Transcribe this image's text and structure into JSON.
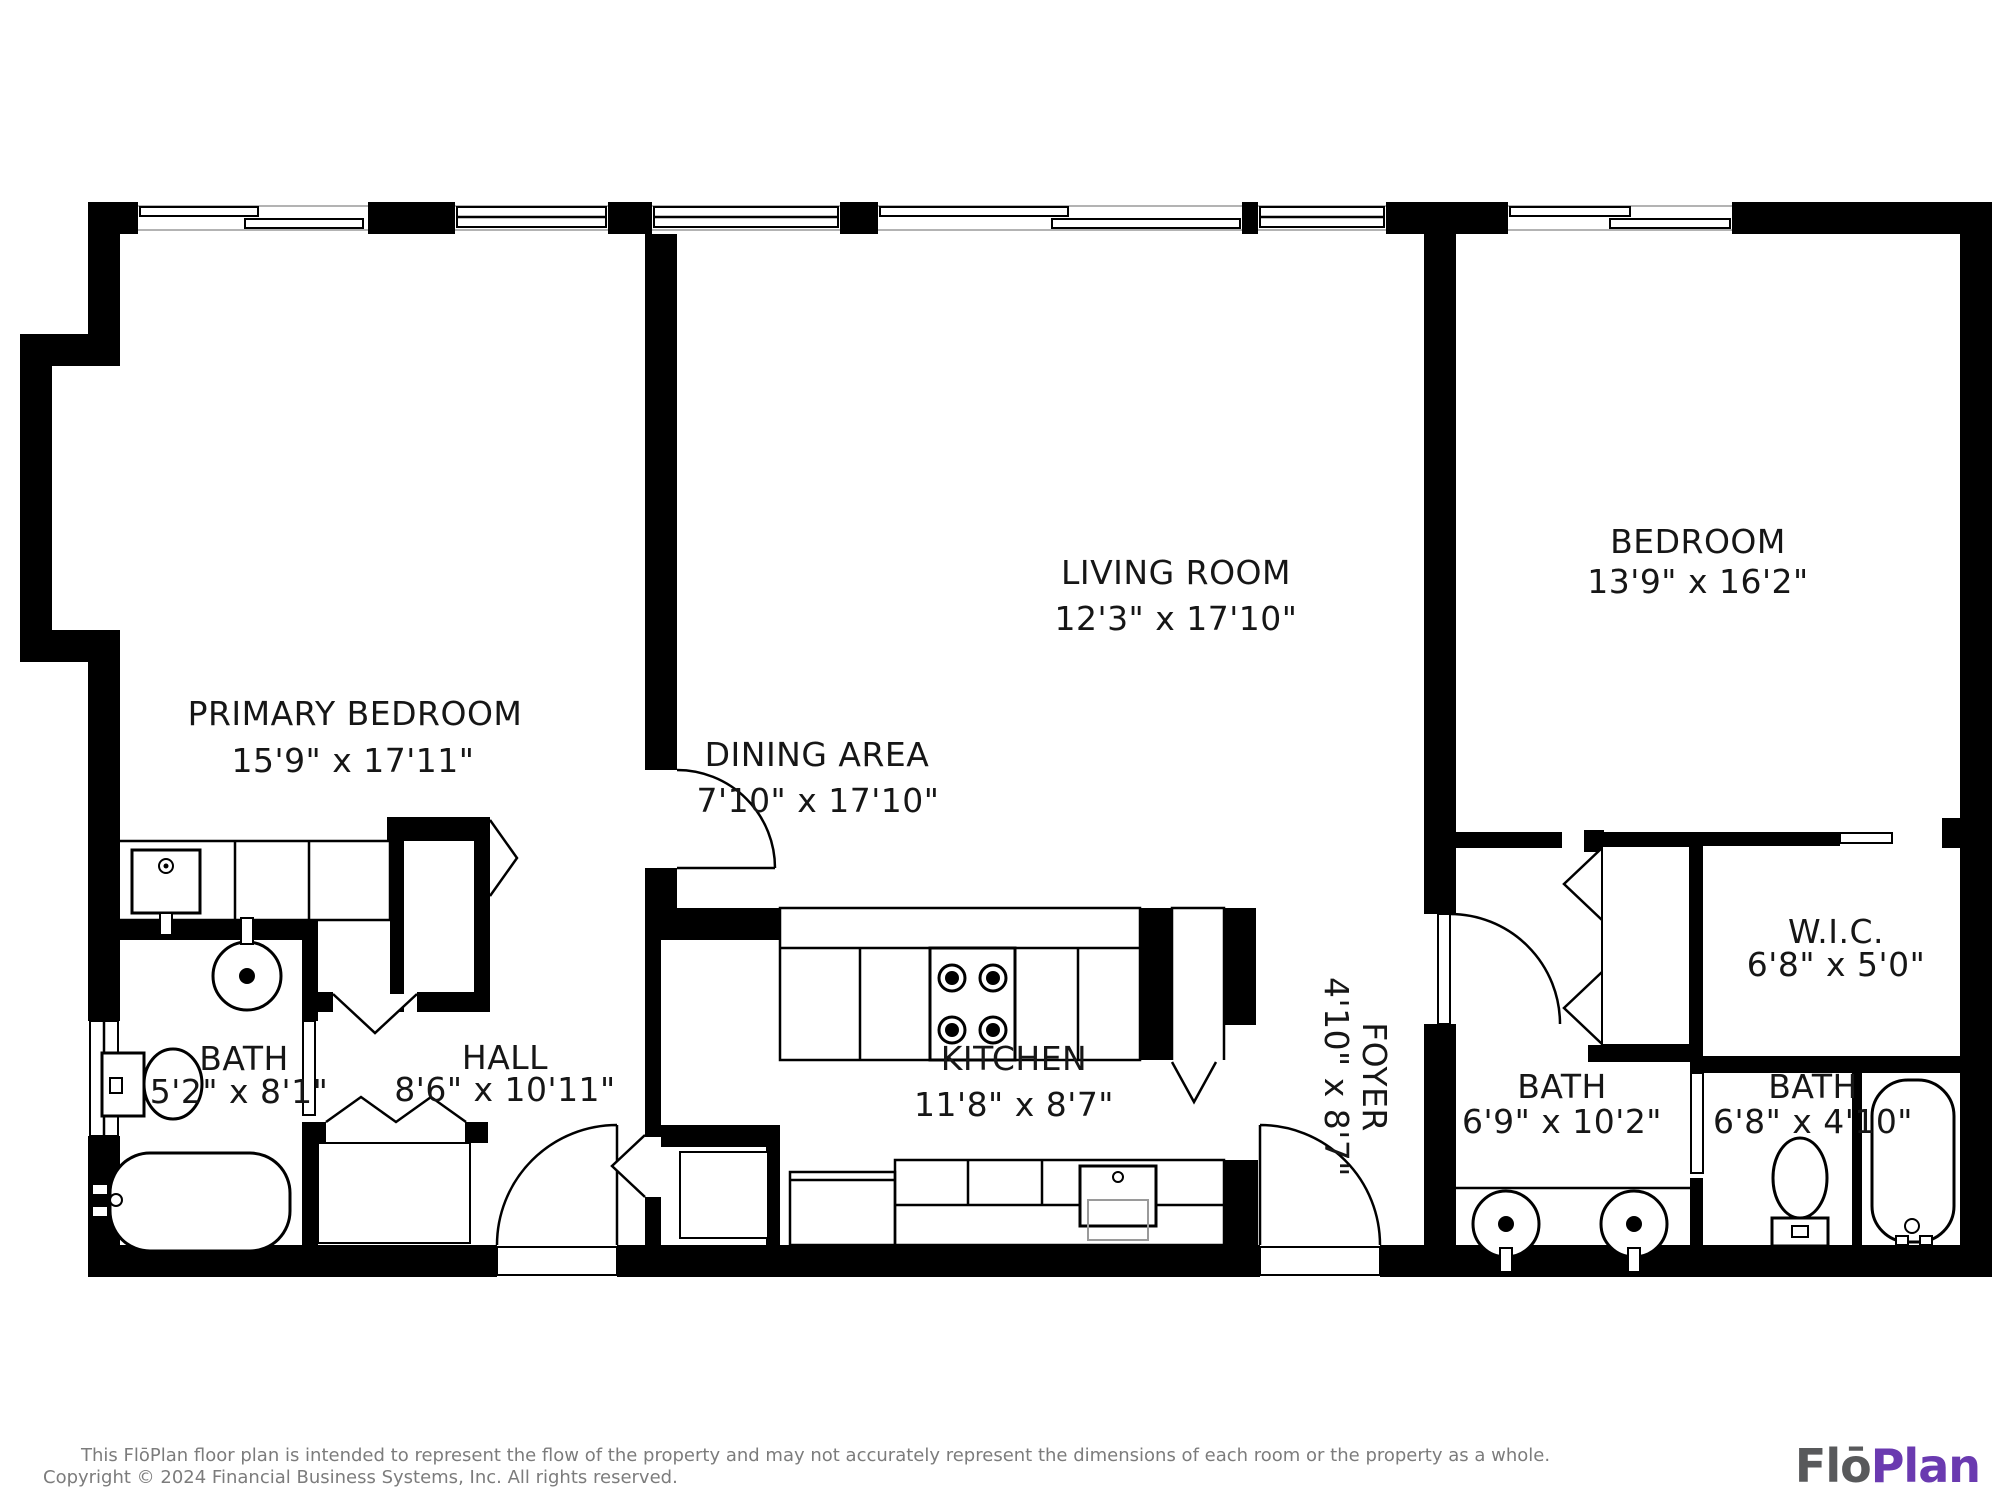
{
  "plan": {
    "rooms": [
      {
        "id": "primary-bedroom",
        "name": "PRIMARY BEDROOM",
        "dims": "15'9\" x 17'11\""
      },
      {
        "id": "dining-area",
        "name": "DINING AREA",
        "dims": "7'10\" x 17'10\""
      },
      {
        "id": "living-room",
        "name": "LIVING ROOM",
        "dims": "12'3\" x 17'10\""
      },
      {
        "id": "bedroom",
        "name": "BEDROOM",
        "dims": "13'9\" x 16'2\""
      },
      {
        "id": "bath-primary",
        "name": "BATH",
        "dims": "5'2\" x 8'1\""
      },
      {
        "id": "hall",
        "name": "HALL",
        "dims": "8'6\" x 10'11\""
      },
      {
        "id": "kitchen",
        "name": "KITCHEN",
        "dims": "11'8\" x 8'7\""
      },
      {
        "id": "foyer",
        "name": "FOYER",
        "dims": "4'10\" x 8'7\""
      },
      {
        "id": "wic",
        "name": "W.I.C.",
        "dims": "6'8\" x 5'0\""
      },
      {
        "id": "bath-hall",
        "name": "BATH",
        "dims": "6'9\" x 10'2\""
      },
      {
        "id": "bath-second",
        "name": "BATH",
        "dims": "6'8\" x 4'10\""
      }
    ],
    "footer": {
      "line1": "This FlōPlan floor plan is intended to represent the flow of the property and may not accurately represent the dimensions of each room or the property as a whole.",
      "line2": "Copyright © 2024 Financial Business Systems, Inc. All rights reserved."
    },
    "logo": {
      "part1": "Flō",
      "part2": "Plan",
      "part1_color": "#58595b",
      "part2_color": "#6a3ab0"
    }
  }
}
